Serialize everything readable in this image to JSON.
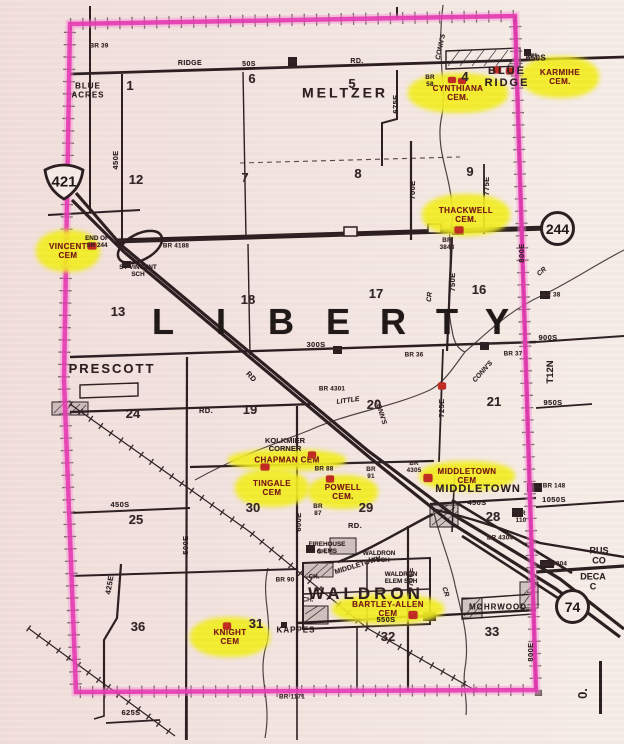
{
  "map_title": "Liberty Township highway map with highlighted cemeteries",
  "township": {
    "name": "LIBERTY",
    "letters": [
      {
        "label": "L",
        "x": 163
      },
      {
        "label": "I",
        "x": 221
      },
      {
        "label": "B",
        "x": 281
      },
      {
        "label": "E",
        "x": 338
      },
      {
        "label": "R",
        "x": 393
      },
      {
        "label": "T",
        "x": 447
      },
      {
        "label": "Y",
        "x": 497
      }
    ],
    "letters_y": 322
  },
  "shields": {
    "us421": {
      "label": "421"
    },
    "sr244": {
      "label": "244"
    },
    "i74": {
      "label": "74"
    }
  },
  "scale": {
    "zero_label": "0."
  },
  "towns": [
    {
      "label": "MELTZER",
      "x": 345,
      "y": 93,
      "fs": 14,
      "ls": 3
    },
    {
      "label": "BLUE\nRIDGE",
      "x": 507,
      "y": 78,
      "fs": 11,
      "ls": 2
    },
    {
      "label": "PRESCOTT",
      "x": 112,
      "y": 369,
      "fs": 13,
      "ls": 2
    },
    {
      "label": "MIDDLETOWN",
      "x": 478,
      "y": 490,
      "fs": 11,
      "ls": 1
    },
    {
      "label": "WALDRON",
      "x": 366,
      "y": 594,
      "fs": 17,
      "ls": 4
    },
    {
      "label": "MOHRWOOD",
      "x": 498,
      "y": 608,
      "fs": 8,
      "ls": 1
    },
    {
      "label": "BLUE\nACRES",
      "x": 88,
      "y": 91,
      "fs": 8,
      "ls": 1
    },
    {
      "label": "KAPPES",
      "x": 296,
      "y": 631,
      "fs": 8,
      "ls": 1
    }
  ],
  "places": [
    {
      "label": "KOLKMIER\nCORNER",
      "x": 285,
      "y": 445,
      "fs": 7.5
    },
    {
      "label": "END OF\nSR 244",
      "x": 97,
      "y": 243,
      "fs": 6.3
    },
    {
      "label": "ST VINCENT\nSCH",
      "x": 138,
      "y": 272,
      "fs": 6.3
    },
    {
      "label": "FIREHOUSE\n& EMS",
      "x": 327,
      "y": 549,
      "fs": 6.3
    },
    {
      "label": "WALDRON\nHI SCH",
      "x": 379,
      "y": 558,
      "fs": 6.3
    },
    {
      "label": "WALDRON\nELEM SCH",
      "x": 401,
      "y": 579,
      "fs": 6.3
    },
    {
      "label": "MIDDLETOWN",
      "x": 358,
      "y": 566,
      "fs": 7,
      "rot": -17
    },
    {
      "label": "RUS\nCO",
      "x": 599,
      "y": 556,
      "fs": 9
    },
    {
      "label": "DECA\nC",
      "x": 593,
      "y": 582,
      "fs": 9
    },
    {
      "label": "T12N",
      "x": 551,
      "y": 372,
      "fs": 9.5,
      "rot": -90
    },
    {
      "label": "CH.",
      "x": 533,
      "y": 57,
      "fs": 6.3
    },
    {
      "label": "CH.",
      "x": 322,
      "y": 553,
      "fs": 6.3
    },
    {
      "label": "CH.",
      "x": 314,
      "y": 578,
      "fs": 6.3
    },
    {
      "label": "CH.",
      "x": 308,
      "y": 601,
      "fs": 6.3
    }
  ],
  "sections": [
    {
      "n": "1",
      "x": 130,
      "y": 86
    },
    {
      "n": "6",
      "x": 252,
      "y": 79
    },
    {
      "n": "5",
      "x": 352,
      "y": 84
    },
    {
      "n": "4",
      "x": 465,
      "y": 77
    },
    {
      "n": "12",
      "x": 136,
      "y": 180
    },
    {
      "n": "7",
      "x": 245,
      "y": 178
    },
    {
      "n": "8",
      "x": 358,
      "y": 174
    },
    {
      "n": "9",
      "x": 470,
      "y": 172
    },
    {
      "n": "13",
      "x": 118,
      "y": 312
    },
    {
      "n": "18",
      "x": 248,
      "y": 300
    },
    {
      "n": "17",
      "x": 376,
      "y": 294
    },
    {
      "n": "16",
      "x": 479,
      "y": 290
    },
    {
      "n": "24",
      "x": 133,
      "y": 414
    },
    {
      "n": "19",
      "x": 250,
      "y": 410
    },
    {
      "n": "20",
      "x": 374,
      "y": 405
    },
    {
      "n": "21",
      "x": 494,
      "y": 402
    },
    {
      "n": "25",
      "x": 136,
      "y": 520
    },
    {
      "n": "30",
      "x": 253,
      "y": 508
    },
    {
      "n": "29",
      "x": 366,
      "y": 508
    },
    {
      "n": "28",
      "x": 493,
      "y": 517
    },
    {
      "n": "36",
      "x": 138,
      "y": 627
    },
    {
      "n": "31",
      "x": 256,
      "y": 624
    },
    {
      "n": "32",
      "x": 388,
      "y": 637
    },
    {
      "n": "33",
      "x": 492,
      "y": 632
    }
  ],
  "cemeteries": [
    {
      "label": "KARMIHE\nCEM.",
      "x": 560,
      "y": 77,
      "w": 78,
      "h": 42
    },
    {
      "label": "CYNTHIANA\nCEM.",
      "x": 458,
      "y": 93,
      "w": 100,
      "h": 40
    },
    {
      "label": "THACKWELL\nCEM.",
      "x": 466,
      "y": 215,
      "w": 88,
      "h": 42
    },
    {
      "label": "VINCENT\nCEM",
      "x": 68,
      "y": 251,
      "w": 64,
      "h": 42
    },
    {
      "label": "CHAPMAN CEM",
      "x": 287,
      "y": 460,
      "w": 118,
      "h": 22
    },
    {
      "label": "TINGALE\nCEM",
      "x": 272,
      "y": 488,
      "w": 74,
      "h": 38
    },
    {
      "label": "POWELL\nCEM.",
      "x": 343,
      "y": 492,
      "w": 70,
      "h": 34
    },
    {
      "label": "MIDDLETOWN\nCEM",
      "x": 467,
      "y": 476,
      "w": 96,
      "h": 30
    },
    {
      "label": "BARTLEY-ALLEN\nCEM",
      "x": 388,
      "y": 609,
      "w": 112,
      "h": 30
    },
    {
      "label": "KNIGHT\nCEM",
      "x": 230,
      "y": 637,
      "w": 80,
      "h": 40
    }
  ],
  "road_labels": [
    {
      "label": "RIDGE",
      "x": 190,
      "y": 64,
      "fs": 7
    },
    {
      "label": "50S",
      "x": 249,
      "y": 65,
      "fs": 7
    },
    {
      "label": "RD.",
      "x": 357,
      "y": 62,
      "fs": 7
    },
    {
      "label": "650S",
      "x": 536,
      "y": 59,
      "fs": 8
    },
    {
      "label": "450E",
      "x": 116,
      "y": 160,
      "rot": -90
    },
    {
      "label": "675E",
      "x": 396,
      "y": 104,
      "rot": -90
    },
    {
      "label": "700E",
      "x": 413,
      "y": 190,
      "rot": -90
    },
    {
      "label": "775E",
      "x": 487,
      "y": 186,
      "rot": -90
    },
    {
      "label": "750E",
      "x": 453,
      "y": 282,
      "rot": -90
    },
    {
      "label": "800E",
      "x": 522,
      "y": 253,
      "rot": -90
    },
    {
      "label": "800E",
      "x": 531,
      "y": 652,
      "rot": -90
    },
    {
      "label": "725E",
      "x": 442,
      "y": 408,
      "rot": -90
    },
    {
      "label": "600E",
      "x": 299,
      "y": 522,
      "rot": -90
    },
    {
      "label": "500E",
      "x": 186,
      "y": 545,
      "rot": -90
    },
    {
      "label": "425E",
      "x": 110,
      "y": 585,
      "rot": -80
    },
    {
      "label": "700E",
      "x": 411,
      "y": 577,
      "rot": -90
    },
    {
      "label": "300S",
      "x": 316,
      "y": 345
    },
    {
      "label": "900S",
      "x": 548,
      "y": 338
    },
    {
      "label": "950S",
      "x": 553,
      "y": 403
    },
    {
      "label": "450S",
      "x": 120,
      "y": 505
    },
    {
      "label": "450S",
      "x": 477,
      "y": 503
    },
    {
      "label": "550S",
      "x": 386,
      "y": 620
    },
    {
      "label": "625S",
      "x": 131,
      "y": 713
    },
    {
      "label": "1050S",
      "x": 554,
      "y": 500
    },
    {
      "label": "RD.",
      "x": 206,
      "y": 411
    },
    {
      "label": "RD",
      "x": 251,
      "y": 377,
      "rot": 48
    },
    {
      "label": "RD.",
      "x": 355,
      "y": 526
    }
  ],
  "bridges": [
    {
      "label": "BR 39",
      "x": 99,
      "y": 47
    },
    {
      "label": "BR\n58",
      "x": 430,
      "y": 82
    },
    {
      "label": "BR 4188",
      "x": 176,
      "y": 247
    },
    {
      "label": "BR\n3843",
      "x": 447,
      "y": 245
    },
    {
      "label": "BR 38",
      "x": 551,
      "y": 296
    },
    {
      "label": "BR 36",
      "x": 414,
      "y": 356
    },
    {
      "label": "BR 37",
      "x": 513,
      "y": 355
    },
    {
      "label": "BR 4301",
      "x": 332,
      "y": 390
    },
    {
      "label": "BR 88",
      "x": 324,
      "y": 470
    },
    {
      "label": "BR\n87",
      "x": 318,
      "y": 511
    },
    {
      "label": "BR\n91",
      "x": 371,
      "y": 474
    },
    {
      "label": "BR\n4305",
      "x": 414,
      "y": 468
    },
    {
      "label": "BR 148",
      "x": 554,
      "y": 487
    },
    {
      "label": "BR\n110",
      "x": 521,
      "y": 518
    },
    {
      "label": "BR 4304",
      "x": 500,
      "y": 539
    },
    {
      "label": "BR 4304",
      "x": 554,
      "y": 565
    },
    {
      "label": "BR 90",
      "x": 285,
      "y": 581
    },
    {
      "label": "BR 1171",
      "x": 292,
      "y": 698
    }
  ],
  "creek_labels": [
    {
      "label": "CONN'S",
      "x": 441,
      "y": 47,
      "rot": -78
    },
    {
      "label": "CONN'S",
      "x": 483,
      "y": 372,
      "rot": -48
    },
    {
      "label": "CONN'S",
      "x": 380,
      "y": 412,
      "rot": 72
    },
    {
      "label": "LITTLE",
      "x": 348,
      "y": 401,
      "rot": -8
    },
    {
      "label": "CR",
      "x": 430,
      "y": 297,
      "rot": -85
    },
    {
      "label": "CR",
      "x": 542,
      "y": 272,
      "rot": -40
    },
    {
      "label": "CR",
      "x": 445,
      "y": 592,
      "rot": 72
    }
  ],
  "markers": [
    {
      "x": 92,
      "y": 246,
      "w": 9,
      "h": 7
    },
    {
      "x": 452,
      "y": 80,
      "w": 8,
      "h": 6
    },
    {
      "x": 462,
      "y": 81,
      "w": 8,
      "h": 6
    },
    {
      "x": 497,
      "y": 70,
      "w": 8,
      "h": 7
    },
    {
      "x": 510,
      "y": 71,
      "w": 8,
      "h": 7
    },
    {
      "x": 459,
      "y": 230,
      "w": 9,
      "h": 7
    },
    {
      "x": 312,
      "y": 455,
      "w": 8,
      "h": 7
    },
    {
      "x": 265,
      "y": 467,
      "w": 9,
      "h": 7
    },
    {
      "x": 330,
      "y": 479,
      "w": 8,
      "h": 7
    },
    {
      "x": 428,
      "y": 478,
      "w": 9,
      "h": 8
    },
    {
      "x": 442,
      "y": 386,
      "w": 8,
      "h": 7
    },
    {
      "x": 413,
      "y": 615,
      "w": 9,
      "h": 8
    },
    {
      "x": 227,
      "y": 626,
      "w": 8,
      "h": 7
    }
  ]
}
